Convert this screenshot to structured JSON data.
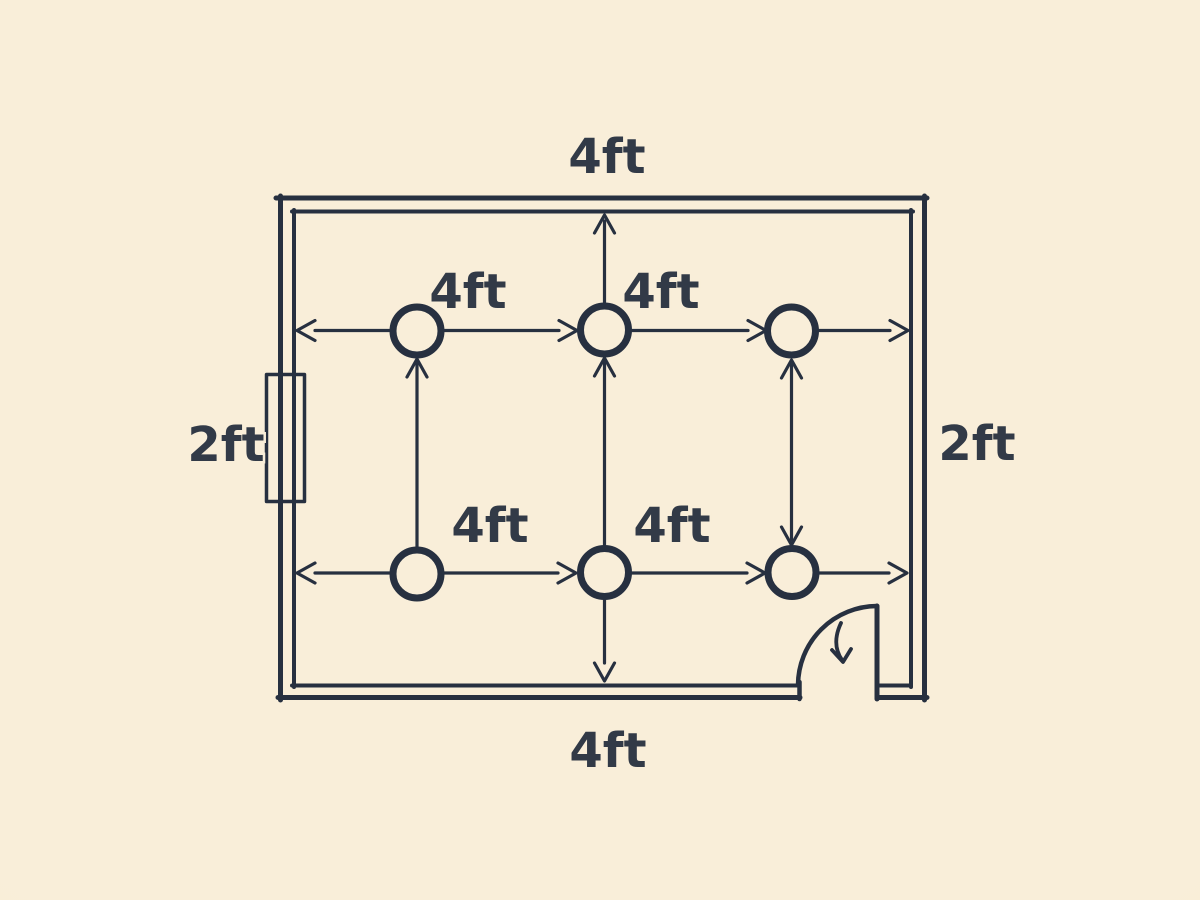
{
  "colors": {
    "background": "#f9eed9",
    "line": "#273040",
    "text": "#323a47"
  },
  "room": {
    "wall_labels": {
      "top": "4ft",
      "bottom": "4ft",
      "left": "2ft",
      "right": "2ft"
    },
    "spacing_labels": {
      "top_row_left": "4ft",
      "top_row_right": "4ft",
      "bottom_row_left": "4ft",
      "bottom_row_right": "4ft"
    },
    "fixtures": {
      "rows": 2,
      "columns": 3,
      "count": 6
    }
  }
}
